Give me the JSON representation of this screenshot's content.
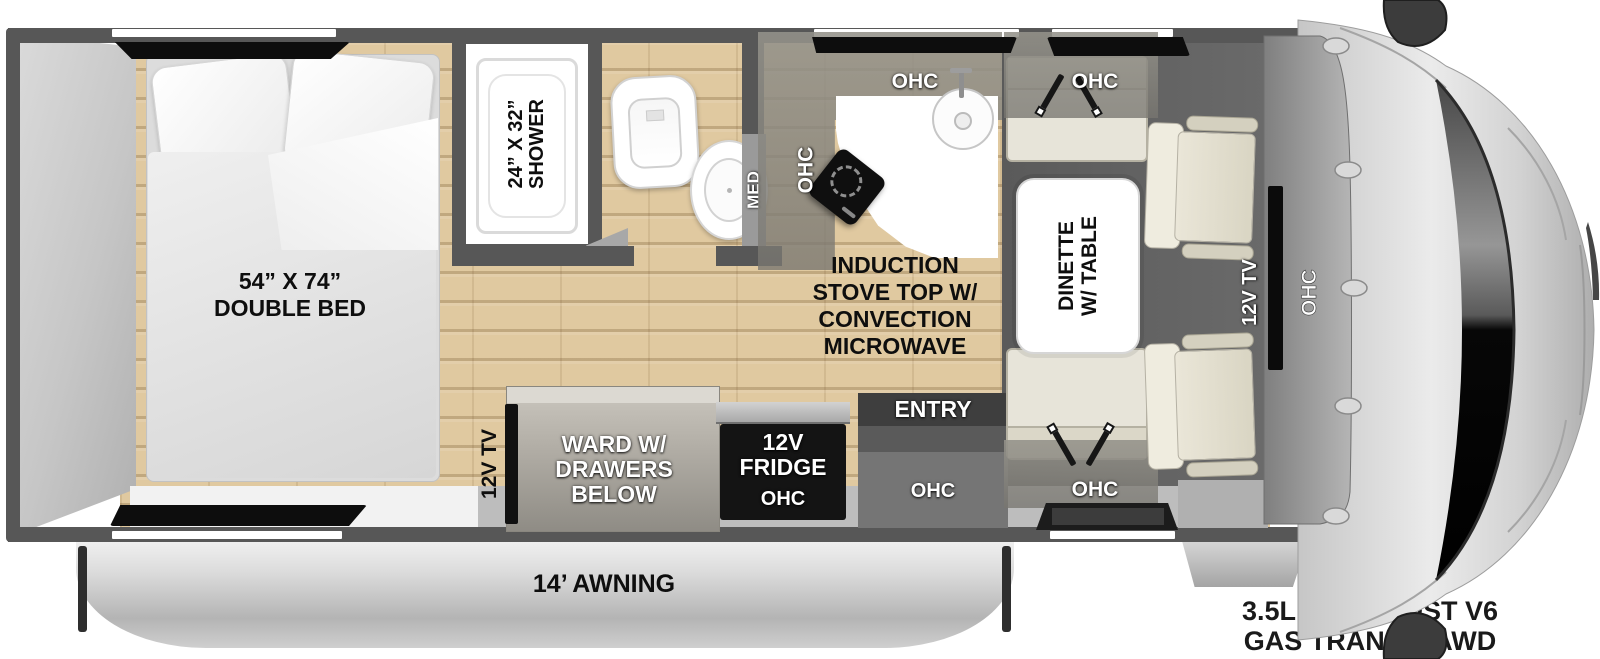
{
  "labels": {
    "ohc": "OHC",
    "bed1": "54” X 74”",
    "bed2": "DOUBLE BED",
    "shower1": "24” X 32”",
    "shower2": "SHOWER",
    "med": "MED",
    "stove1": "INDUCTION",
    "stove2": "STOVE TOP W/",
    "stove3": "CONVECTION",
    "stove4": "MICROWAVE",
    "dinette1": "DINETTE",
    "dinette2": "W/ TABLE",
    "tv_front": "12V TV",
    "tv_rear": "12V TV",
    "entry": "ENTRY",
    "fridge1": "12V",
    "fridge2": "FRIDGE",
    "ward1": "WARD W/",
    "ward2": "DRAWERS",
    "ward3": "BELOW",
    "awning": "14’ AWNING",
    "engine1": "3.5L ECOBOOST V6",
    "engine2": "GAS TRANSIT AWD"
  },
  "colors": {
    "wall": "#575757",
    "wood_floor": "#e0c9a0",
    "dark_floor": "#5f5f5f",
    "bench": "#e7e4d9",
    "fridge": "#141414",
    "awning_silver": "#c9c9c9",
    "label_black": "#0e0e0e",
    "label_white": "#ffffff"
  }
}
